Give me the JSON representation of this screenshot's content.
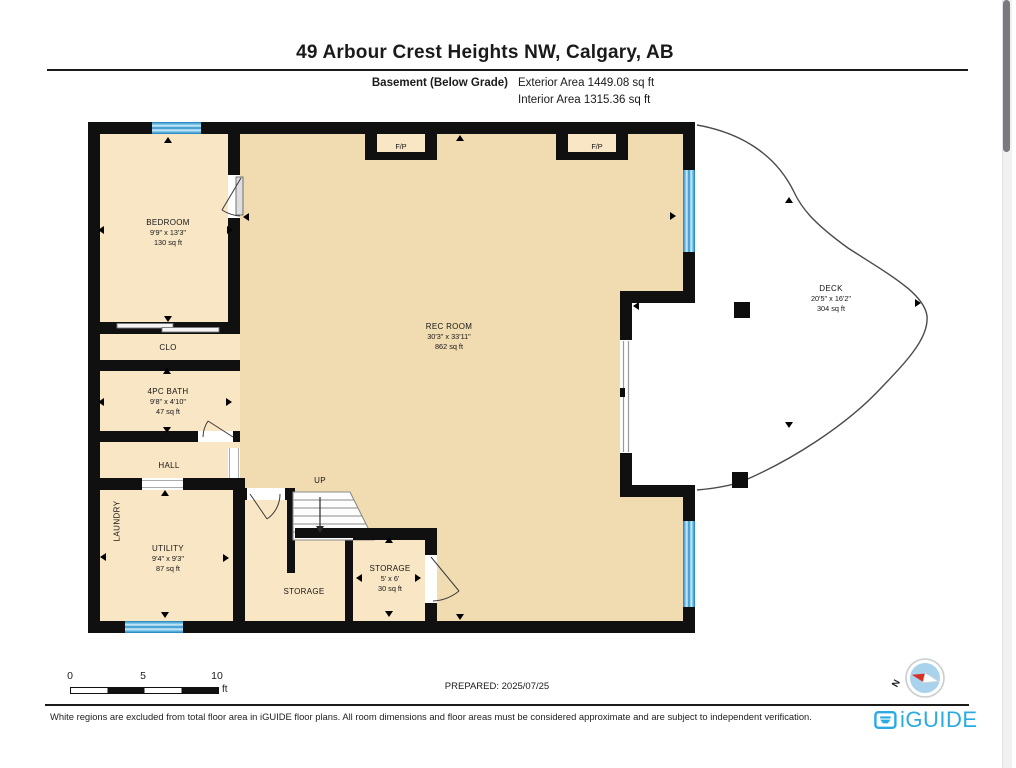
{
  "header": {
    "title": "49 Arbour Crest Heights NW, Calgary, AB",
    "floor_label": "Basement (Below Grade)",
    "exterior_area": "Exterior Area 1449.08 sq ft",
    "interior_area": "Interior Area 1315.36 sq ft"
  },
  "rooms": {
    "bedroom": {
      "name": "BEDROOM",
      "dims": "9'9\" x 13'3\"",
      "area": "130 sq ft"
    },
    "closet": {
      "name": "CLO"
    },
    "bath": {
      "name": "4PC BATH",
      "dims": "9'8\" x 4'10\"",
      "area": "47 sq ft"
    },
    "hall": {
      "name": "HALL"
    },
    "laundry": {
      "name": "LAUNDRY"
    },
    "utility": {
      "name": "UTILITY",
      "dims": "9'4\" x 9'3\"",
      "area": "87 sq ft"
    },
    "storage_under_stairs": {
      "name": "STORAGE"
    },
    "storage_small": {
      "name": "STORAGE",
      "dims": "5' x 6'",
      "area": "30 sq ft"
    },
    "rec_room": {
      "name": "REC ROOM",
      "dims": "30'3\" x 33'11\"",
      "area": "862 sq ft"
    },
    "deck": {
      "name": "DECK",
      "dims": "20'5\" x 16'2\"",
      "area": "304 sq ft"
    },
    "fireplace_left": {
      "name": "F/P"
    },
    "fireplace_right": {
      "name": "F/P"
    },
    "stairs": {
      "direction_label": "UP"
    }
  },
  "scale_bar": {
    "ticks": [
      "0",
      "5",
      "10"
    ],
    "unit": "ft"
  },
  "prepared_label": "PREPARED: 2025/07/25",
  "compass": {
    "north_label": "N"
  },
  "footer": {
    "disclaimer": "White regions are excluded from total floor area in iGUIDE floor plans. All room dimensions and floor areas must be considered approximate and are subject to independent verification.",
    "brand": "iGUIDE"
  },
  "colors": {
    "wall": "#101010",
    "room_fill_main": "#F1DCB2",
    "room_fill_light": "#F9E6C5",
    "window_blue": "#4AA5D6",
    "brand_teal": "#29ABE2",
    "compass_red": "#D93025"
  }
}
